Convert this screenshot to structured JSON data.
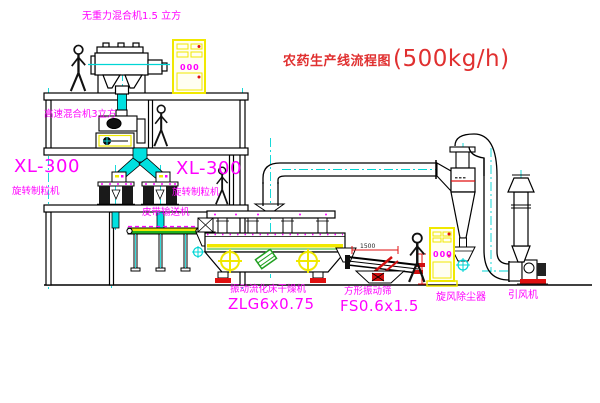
{
  "title": {
    "name_cn": "农药生产线流程图",
    "capacity": "(500kg/h)"
  },
  "labels": {
    "mixer_top": "无重力混合机1.5 立方",
    "mixer_floor2": "高速混合机3立方",
    "granulator_model_left": "XL-300",
    "granulator_name_left": "旋转制粒机",
    "granulator_model_right": "XL-300",
    "granulator_name_right": "旋转制粒机",
    "conveyor": "皮带输送机",
    "dryer_name": "振动流化床干燥机",
    "dryer_model": "ZLG6x0.75",
    "sieve_name": "方形振动筛",
    "sieve_model": "FS0.6x1.5",
    "cyclone": "旋风除尘器",
    "fan": "引风机"
  },
  "annotations": {
    "dim_1500": "1500",
    "cabinet_a_display": "000",
    "cabinet_b_display": "000"
  },
  "colors": {
    "label_magenta": "#ff00ff",
    "title_red": "#e03030",
    "cad_red": "#e01010",
    "centerline_cyan": "#00d5d5",
    "equipment_yellow": "#f0e800",
    "accent_green": "#20a020"
  }
}
